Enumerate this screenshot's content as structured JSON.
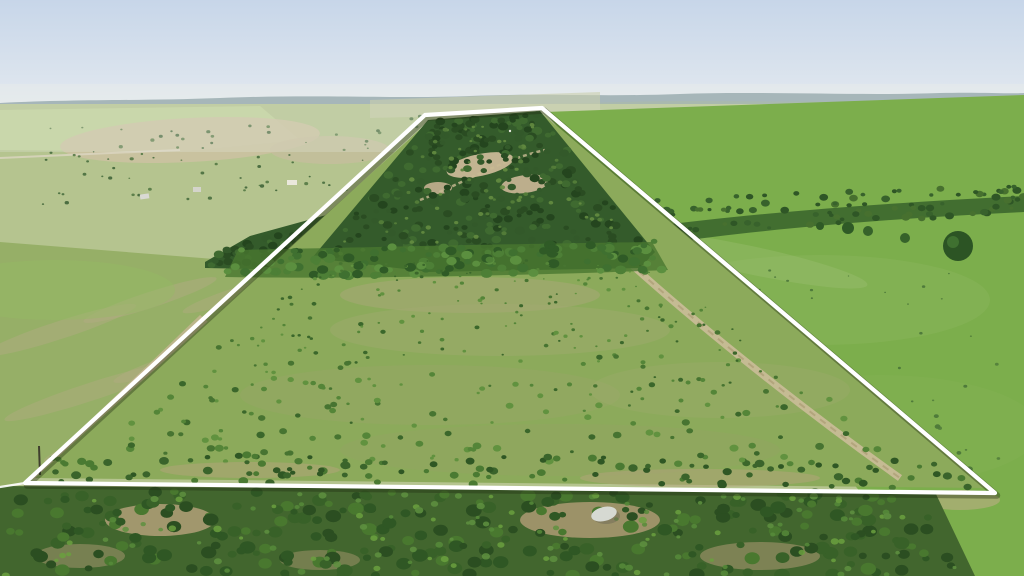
{
  "image": {
    "kind": "aerial drone photograph",
    "description": "Aerial drone photo of a rural ranch property outlined with a white boundary overlay: dense oak woods across the upper portion of the tract, open brush-dotted pasture inside the boundary, plowed field and dirt two-track to the west, smooth green pasture to the east, hazy hills and farm fields with a stock pond on the horizon, and a belt of scrub trees along the bottom edge",
    "width_px": 1024,
    "height_px": 576
  },
  "overlay": {
    "boundary": {
      "shape": "trapezoid-polygon",
      "points": "25,483 425,115 542,108 995,493",
      "tail_points": "0,487 25,483",
      "stroke_color": "#ffffff",
      "shadow_color": "rgba(35,45,18,0.38)"
    }
  },
  "palette": {
    "sky_top": "#c7d6e9",
    "sky_horizon": "#ecefee",
    "far_hills": "#9fb0b4",
    "near_ridge": "#aab9ae",
    "mid_fields": "#b5c48f",
    "mid_tan": "#c7bc9c",
    "woods_dark": "#345b2b",
    "tree_belt": "#49772f",
    "interior_pasture": "#8caa5b",
    "left_field": "#96af67",
    "right_pasture": "#7cae4c",
    "dirt_road": "#cbbd99",
    "ground_tan": "#b2a078",
    "bottom_scrub_base": "#42662e",
    "pond": "#87a3a7",
    "rock": "#d6d9d2",
    "boundary_white": "#ffffff"
  },
  "features": [
    {
      "name": "property-boundary-overlay",
      "label": "White surveyed boundary outline drawn over the land"
    },
    {
      "name": "wooded-upland",
      "label": "Dense dark-green oak woods across the upper half of the tract",
      "approx_xy": [
        480,
        190
      ]
    },
    {
      "name": "rocky-clearings",
      "label": "Tan rocky clearings and trails inside the woods",
      "approx_xy": [
        490,
        170
      ]
    },
    {
      "name": "open-pasture",
      "label": "Open pasture dotted with small brush inside the boundary",
      "approx_xy": [
        500,
        370
      ]
    },
    {
      "name": "east-perimeter-two-track",
      "label": "Dirt two-track running inside the east boundary line",
      "approx_xy": [
        760,
        370
      ]
    },
    {
      "name": "west-field-road",
      "label": "Dirt field road running outside the west boundary line",
      "approx_xy": [
        200,
        345
      ]
    },
    {
      "name": "west-plowed-field",
      "label": "Mottled green and tan plowed field west of the property",
      "approx_xy": [
        120,
        360
      ]
    },
    {
      "name": "east-green-pasture",
      "label": "Smooth bright-green pasture east of the property",
      "approx_xy": [
        850,
        330
      ]
    },
    {
      "name": "south-scrub-belt",
      "label": "Belt of dense scrub trees along the bottom of the frame",
      "approx_xy": [
        400,
        530
      ]
    },
    {
      "name": "rock-outcrop",
      "label": "Light limestone rock patch among the bottom trees",
      "approx_xy": [
        603,
        514
      ]
    },
    {
      "name": "stock-pond",
      "label": "Small gray-blue stock pond on distant neighboring land",
      "approx_xy": [
        888,
        169
      ]
    },
    {
      "name": "farm-buildings",
      "label": "Scattered small farm buildings among the distant fields"
    },
    {
      "name": "utility-pole",
      "label": "Utility pole near the southwest boundary corner",
      "approx_xy": [
        39,
        460
      ]
    },
    {
      "name": "horizon-ridge",
      "label": "Hazy blue-gray hill ridge on the horizon"
    }
  ]
}
